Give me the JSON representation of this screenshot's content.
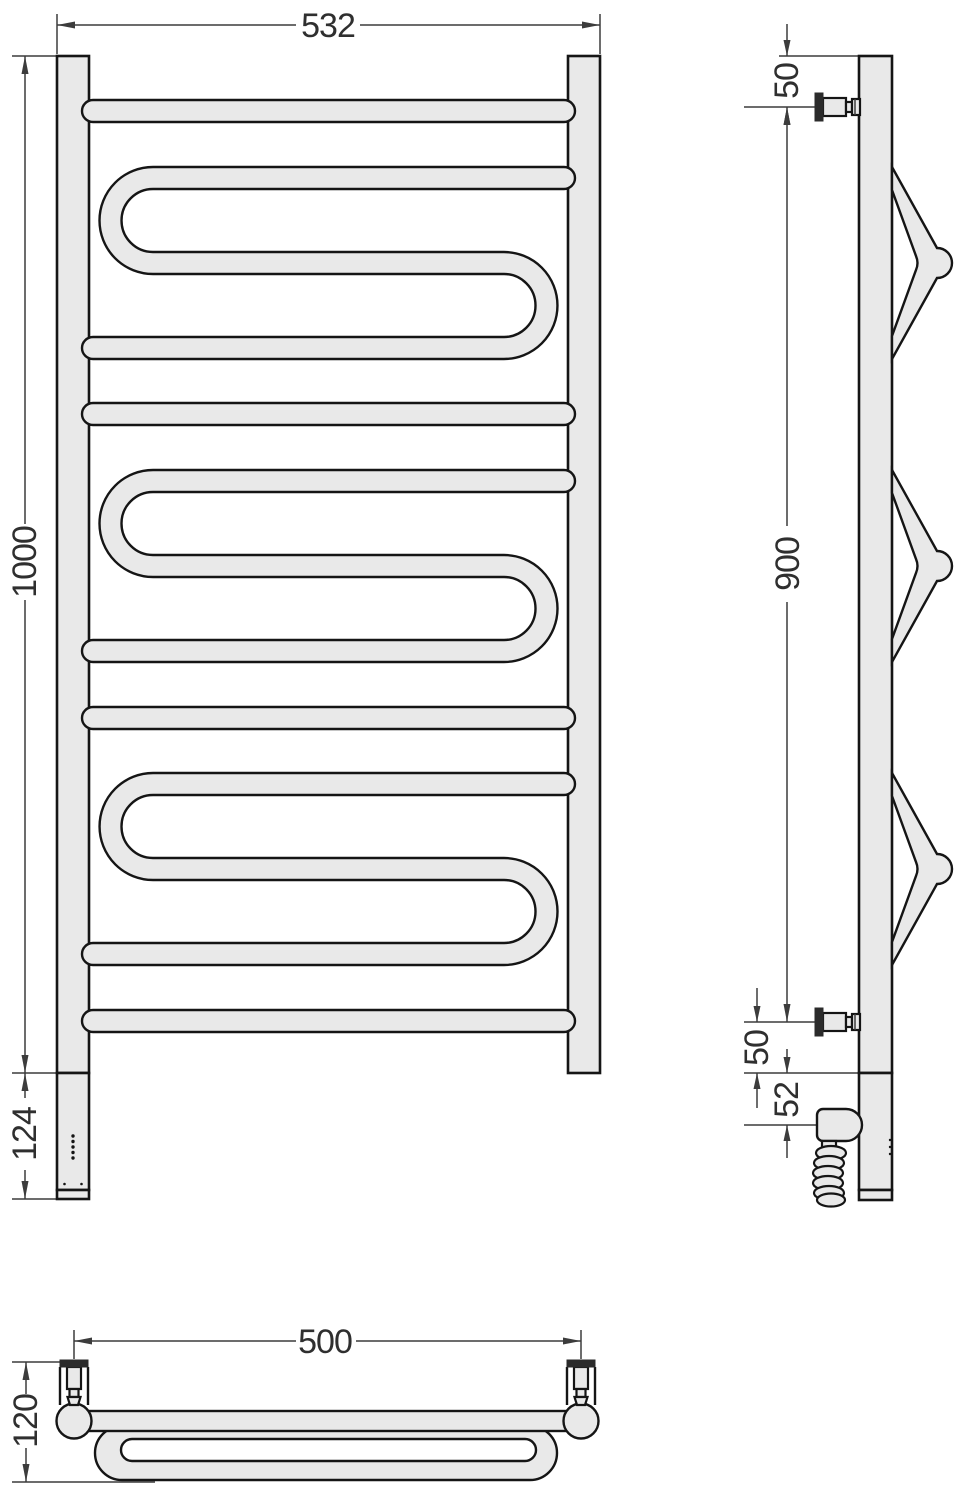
{
  "colors": {
    "background": "#ffffff",
    "fill": "#e9e9e9",
    "line": "#151515",
    "dim": "#3c3c3c",
    "text": "#2f2f2f",
    "flange": "#2b2b2b"
  },
  "front_view": {
    "width_label": "532",
    "height_label": "1000",
    "heater_section_label": "124"
  },
  "side_view": {
    "top_bracket_offset_label": "50",
    "bracket_span_label": "900",
    "bottom_bracket_offset_label": "50",
    "heater_axis_offset_label": "52"
  },
  "bottom_view": {
    "bracket_span_label": "500",
    "depth_label": "120"
  }
}
